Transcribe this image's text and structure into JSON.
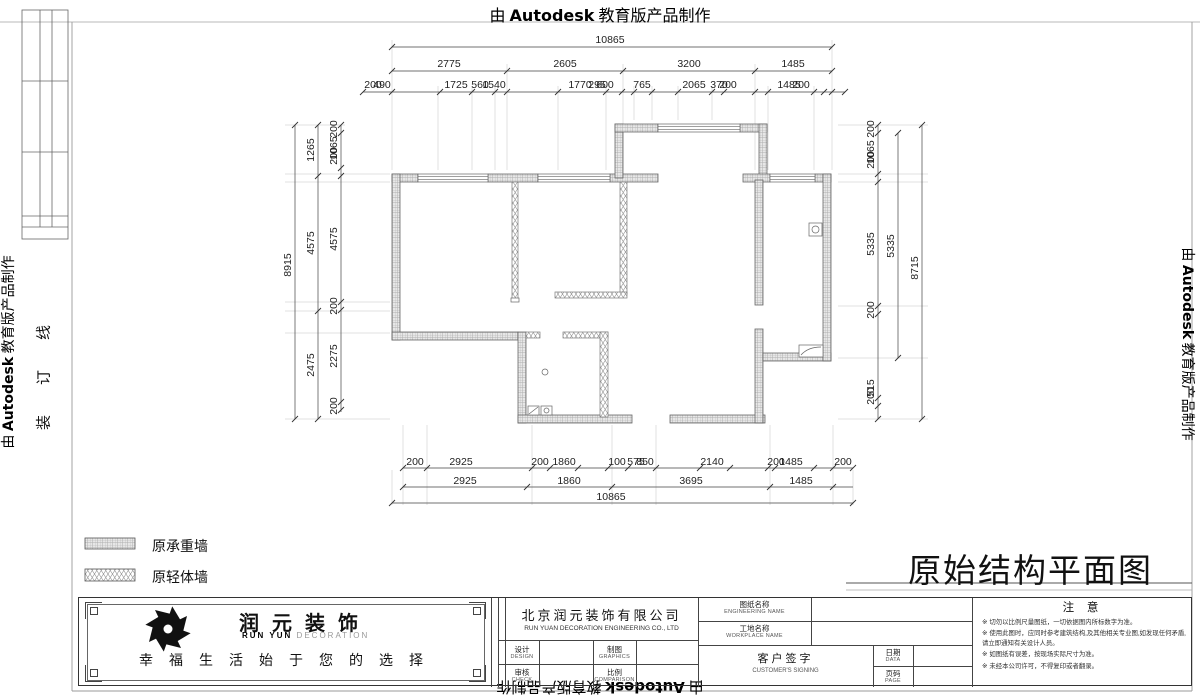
{
  "banner": {
    "prefix": "由",
    "brand": "Autodesk",
    "suffix": "教育版产品制作"
  },
  "binding_line": "装订线",
  "drawing_title": "原始结构平面图",
  "legend": {
    "items": [
      {
        "label": "原承重墙"
      },
      {
        "label": "原轻体墙"
      }
    ]
  },
  "plan": {
    "dims": {
      "top_total": "10865",
      "top_row2": [
        "2775",
        "2605",
        "3200",
        "1485"
      ],
      "top_row3": [
        "200",
        "490",
        "1725",
        "560",
        "1540",
        "1770",
        "295",
        "600",
        "765",
        "2065",
        "370",
        "200",
        "1485",
        "200"
      ],
      "bottom_row1": [
        "200",
        "2925",
        "200",
        "1860",
        "100",
        "575",
        "850",
        "2140",
        "200",
        "1485",
        "200"
      ],
      "bottom_row2": [
        "2925",
        "1860",
        "3695",
        "1485"
      ],
      "bottom_total": "10865",
      "left_outer": "8915",
      "left_mid": [
        "1265",
        "4575",
        "2475"
      ],
      "left_inner": [
        "200",
        "1065",
        "200",
        "4575",
        "200",
        "2275",
        "200"
      ],
      "right_outer": "8715",
      "right_mid": "5335",
      "right_inner": [
        "200",
        "1065",
        "200",
        "5335",
        "200",
        "515",
        "200"
      ]
    }
  },
  "title_block": {
    "brand_cn": "润元装饰",
    "brand_en_1": "RUN YUN",
    "brand_en_2": "DECORATION",
    "slogan": "幸福生活始于您的选择",
    "company_cn": "北京润元装饰有限公司",
    "company_en": "RUN YUAN DECORATION ENGINEERING CO., LTD",
    "fields": {
      "design_cn": "设计",
      "design_en": "DESIGN",
      "graphics_cn": "制图",
      "graphics_en": "GRAPHICS",
      "check_cn": "审核",
      "check_en": "CHECK",
      "scale_cn": "比例",
      "scale_en": "COMPARISON",
      "eng_name_cn": "图纸名称",
      "eng_name_en": "ENGINEERING NAME",
      "workplace_cn": "工地名称",
      "workplace_en": "WORKPLACE NAME",
      "sign_cn": "客户签字",
      "sign_en": "CUSTOMER'S SIGNING",
      "date_cn": "日期",
      "date_en": "DATA",
      "page_cn": "页码",
      "page_en": "PAGE"
    },
    "notes": {
      "title": "注 意",
      "marker": "※",
      "items": [
        "切勿以比例尺量图纸，一切依据图内所标数字为准。",
        "使用此图时，应同时参考建筑结构,及其他相关专业图,如发现任何矛盾,请立即通知有关设计人员。",
        "如图纸有误差，按现场实际尺寸为准。",
        "未经本公司许可，不得复印或者翻录。"
      ]
    }
  }
}
